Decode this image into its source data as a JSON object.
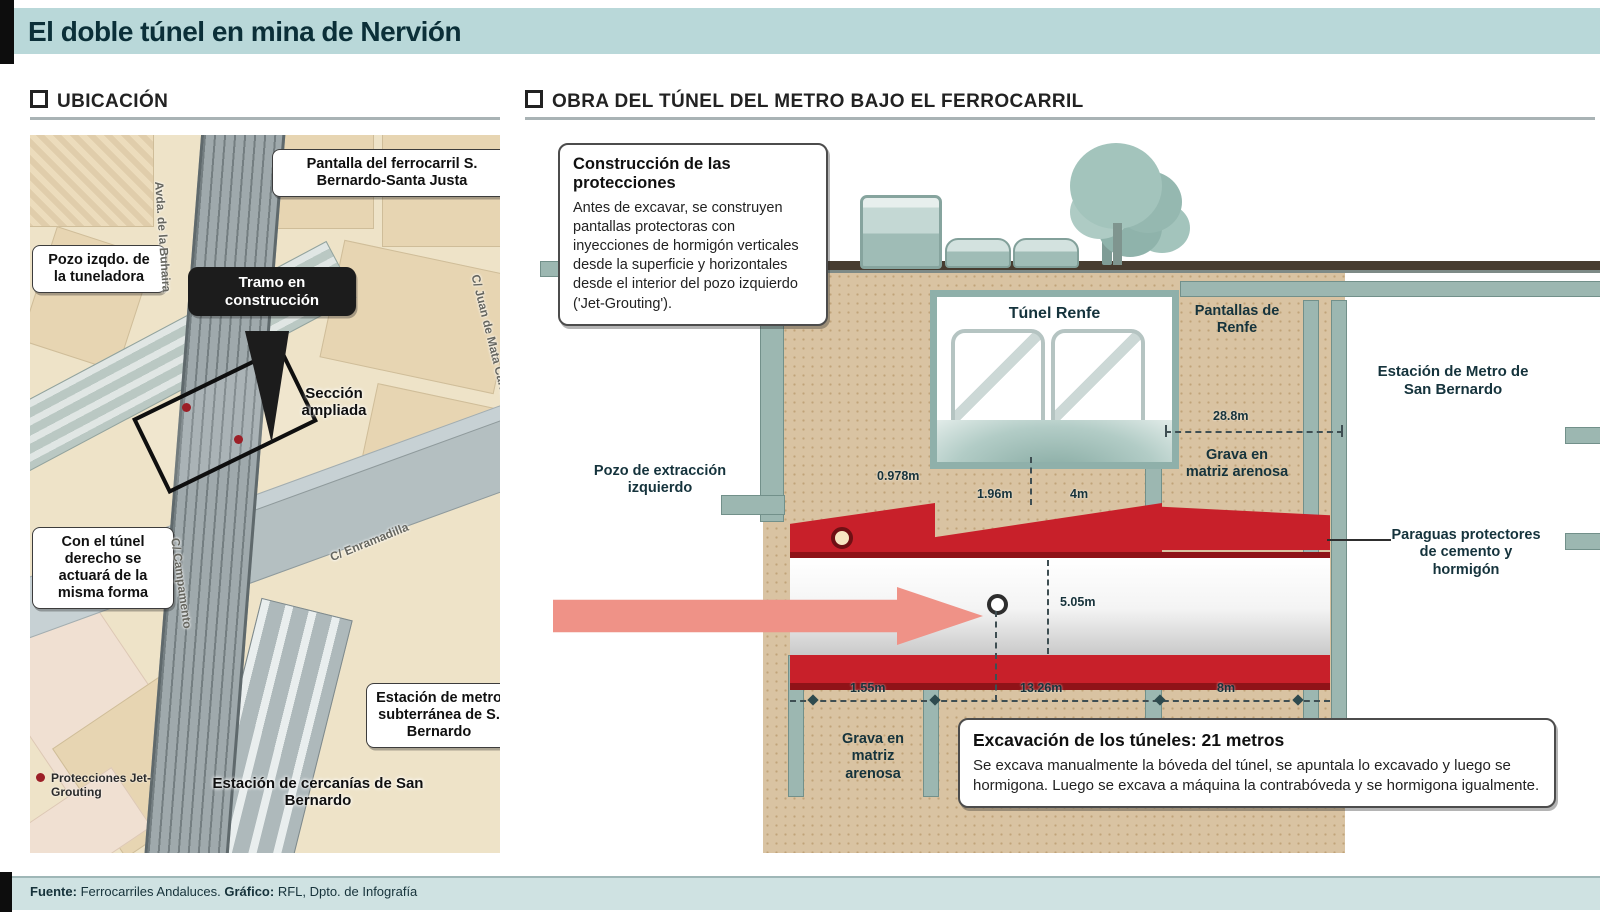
{
  "title_bar": {
    "title": "El doble túnel en mina de Nervión"
  },
  "footer": {
    "source_label": "Fuente:",
    "source_value": " Ferrocarriles Andaluces. ",
    "credit_label": "Gráfico:",
    "credit_value": " RFL, Dpto. de Infografía"
  },
  "location": {
    "header": "UBICACIÓN",
    "callouts": {
      "pantalla": "Pantalla del ferrocarril S. Bernardo-Santa Justa",
      "pozo": "Pozo izqdo. de la tuneladora",
      "tramo": "Tramo en construcción",
      "seccion": "Sección ampliada",
      "tunel_derecho": "Con el túnel derecho se actuará de la misma forma",
      "estacion_metro": "Estación de metro subterránea de S. Bernardo",
      "estacion_cercanias": "Estación de cercanías de San Bernardo"
    },
    "streets": {
      "buhaira": "Avda. de la Buhaira",
      "mata_carriazo": "C/ Juan de Mata Carriazo",
      "enramadilla": "C/ Enramadilla",
      "campamento": "C/ Campamento"
    },
    "legend": {
      "jet_grouting": "Protecciones Jet-Grouting"
    }
  },
  "works": {
    "header": "OBRA DEL TÚNEL DEL METRO BAJO EL FERROCARRIL",
    "construction_box": {
      "title": "Construcción de las protecciones",
      "body": "Antes de excavar, se construyen pantallas protectoras con inyecciones de hormigón verticales desde la superficie y horizontales desde el interior del pozo izquierdo ('Jet-Grouting')."
    },
    "excavation_box": {
      "title": "Excavación de los túneles: 21 metros",
      "body": "Se excava manualmente la bóveda del túnel, se apuntala lo excavado y luego se hormigona. Luego se excava a máquina la contrabóveda y se hormigona igualmente."
    },
    "labels": {
      "tunel_renfe": "Túnel Renfe",
      "pantallas_renfe": "Pantallas de Renfe",
      "grava_right": "Grava en matriz arenosa",
      "grava_bottom": "Grava en matriz arenosa",
      "estacion_metro": "Estación de Metro de San Bernardo",
      "pozo_extraccion": "Pozo de extracción izquierdo",
      "paraguas": "Paraguas protectores de cemento y hormigón"
    },
    "measurements": {
      "renfe_span": "28.8m",
      "wall": "0.978m",
      "sep_small": "1.96m",
      "sep_four": "4m",
      "tunnel_h": "5.05m",
      "bottom_left": "1.55m",
      "bottom_mid": "13.26m",
      "bottom_right": "8m"
    },
    "colors": {
      "accent_red": "#c8202a",
      "arrow_pink": "#ef9287",
      "soil_tan": "#d9c3a2",
      "wall_teal": "#9cb7b1",
      "bar_teal": "#b9d8d9"
    }
  }
}
